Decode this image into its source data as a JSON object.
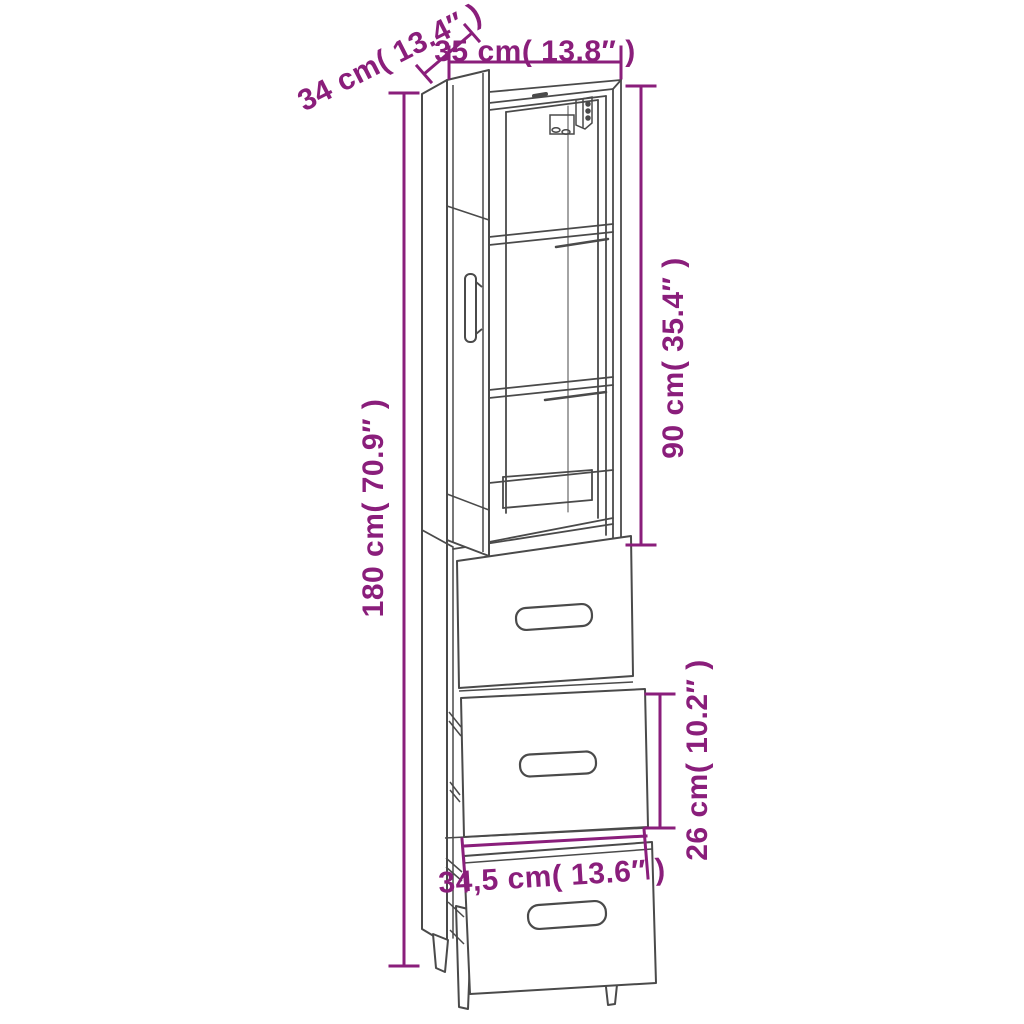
{
  "diagram": {
    "product_name": "highboard cabinet with open glass door, three shelves and three drawers",
    "view": "product dimension line drawing",
    "style": {
      "dimension_color": "#8A1E7B",
      "line_color": "#4A4A4A",
      "background": "#FFFFFF"
    },
    "labels": {
      "depth": "34 cm( 13.4″ )",
      "width": "35 cm( 13.8″ )",
      "upper_section_height": "90 cm( 35.4″ )",
      "total_height": "180 cm( 70.9″ )",
      "drawer_front_height": "26 cm( 10.2″ )",
      "drawer_front_width": "34,5 cm( 13.6″ )"
    }
  }
}
